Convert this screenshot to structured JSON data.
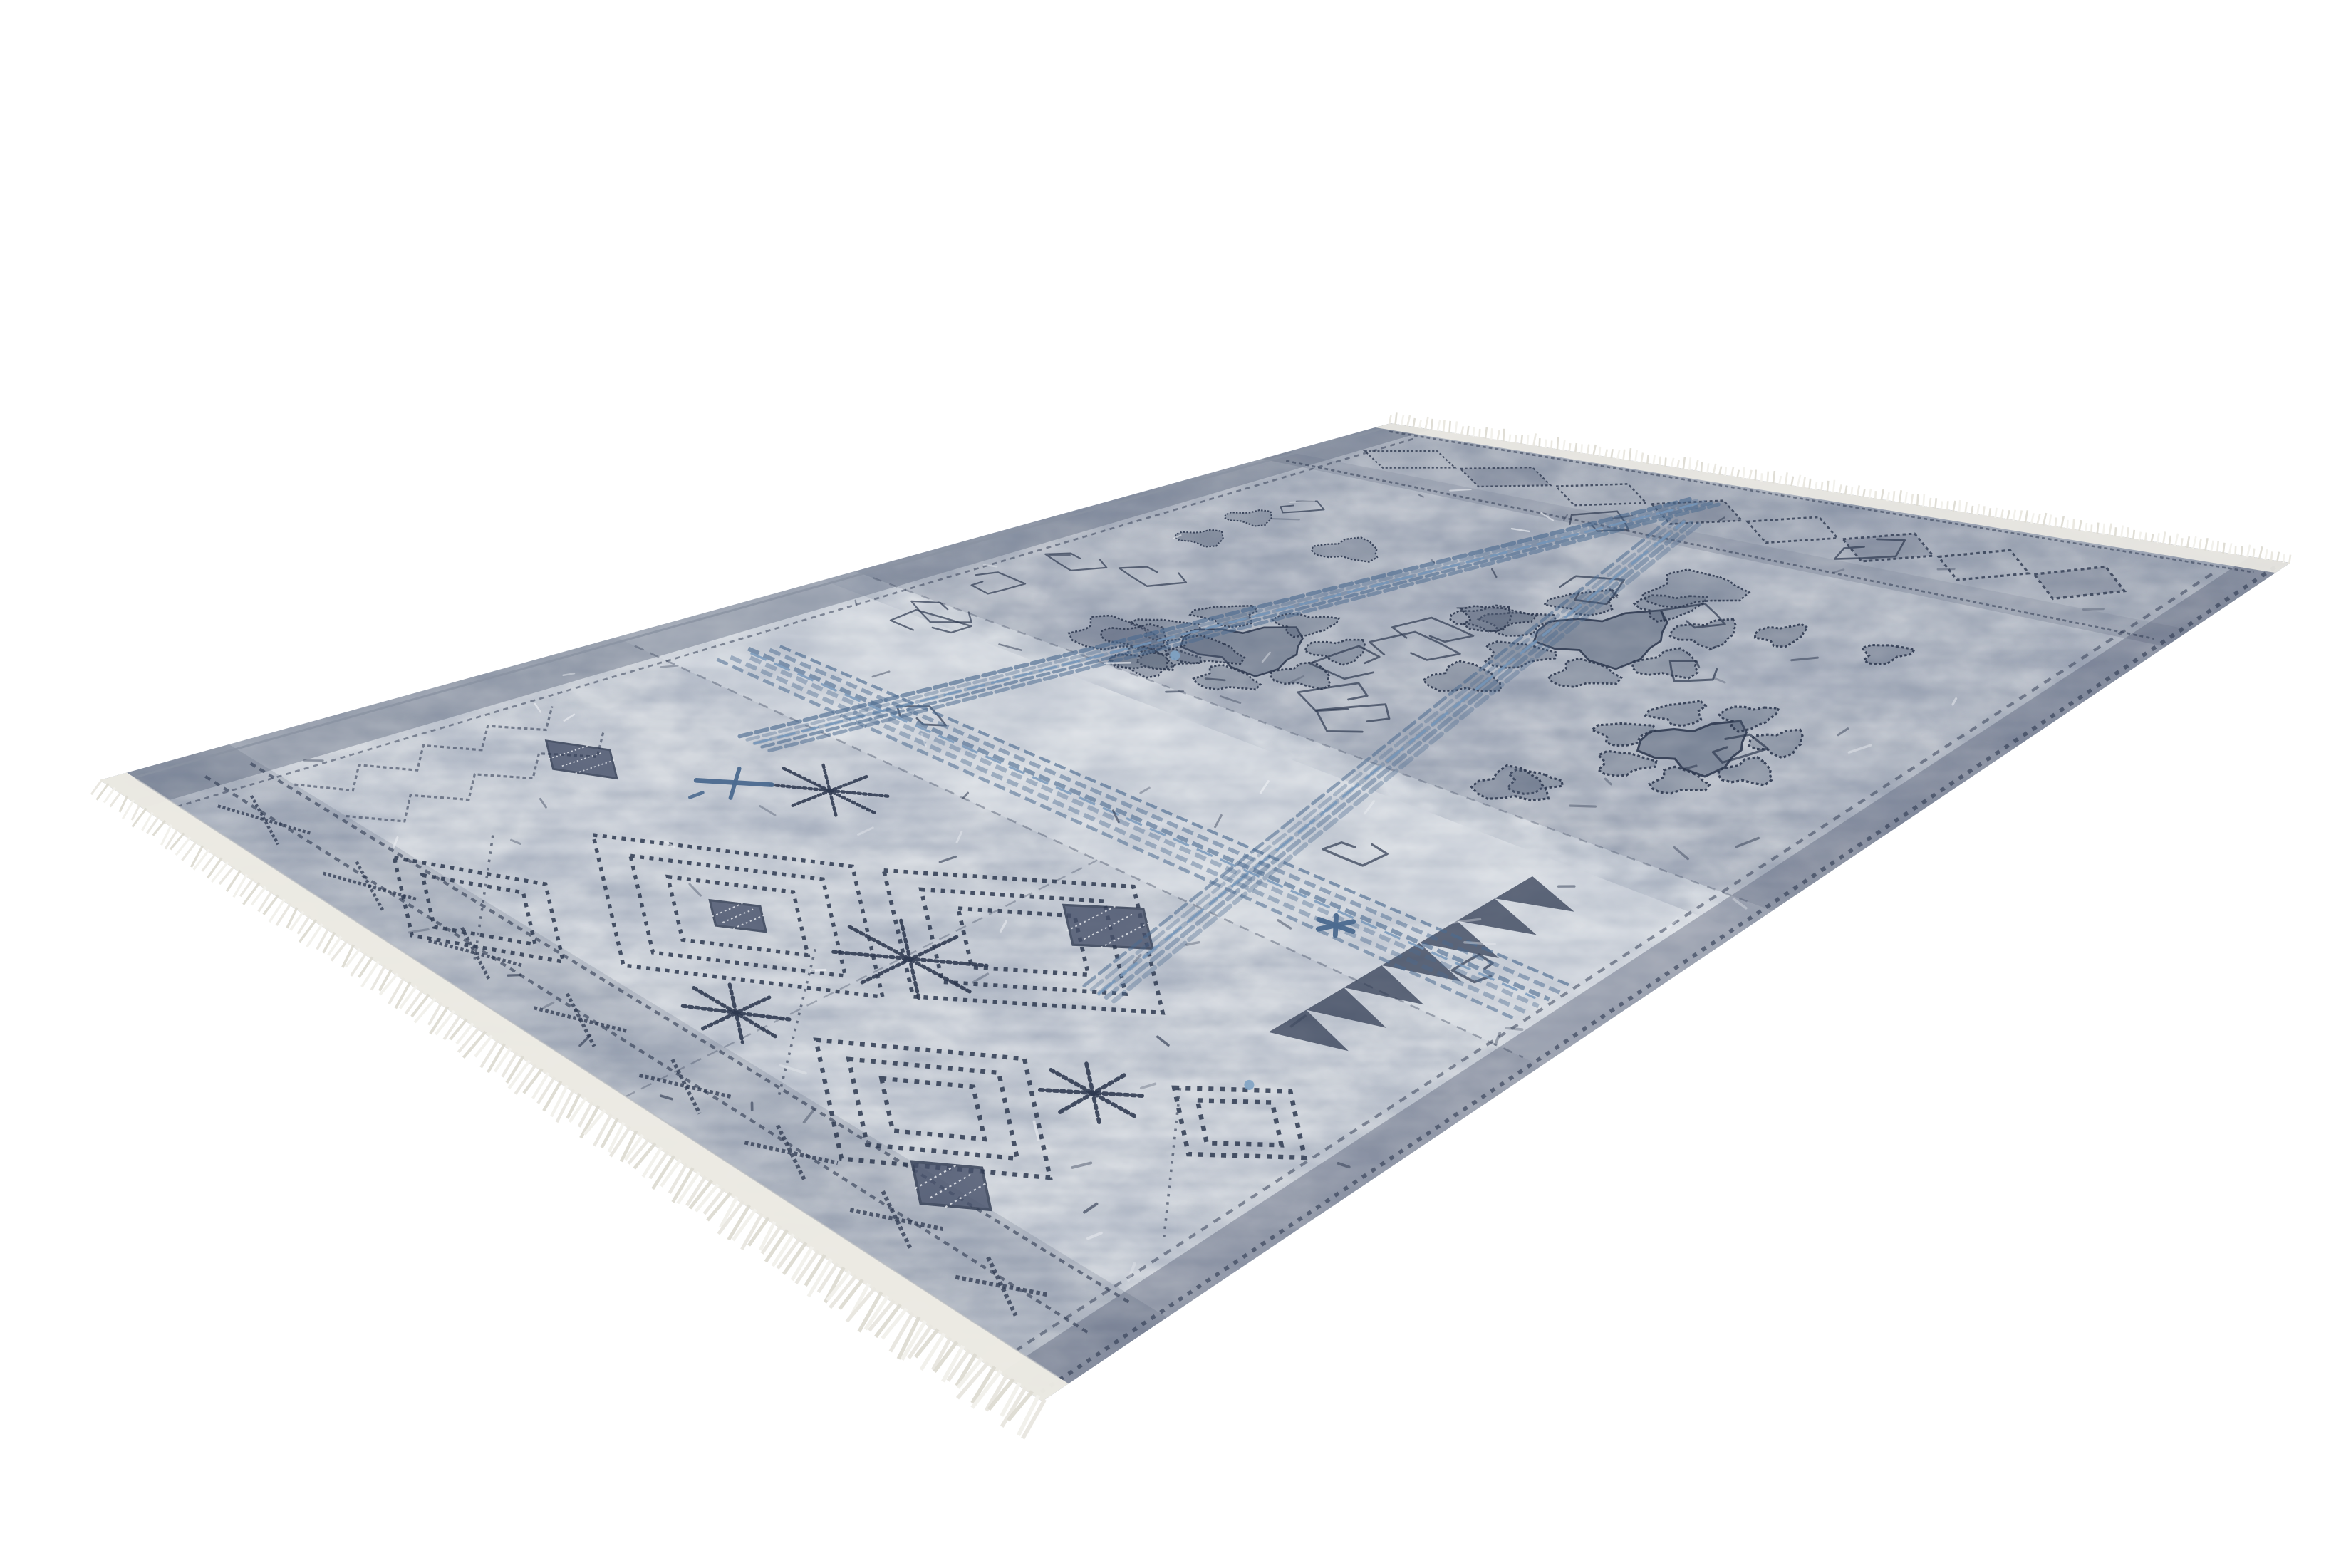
{
  "scene": {
    "description": "Product photo of a rectangular vintage-style area rug shown flat in angled perspective on a plain white background. The rug has a grey-blue patchwork pattern: geometric dotted diamond and snowflake motifs on the left half, dense paisley and floral motifs on the right half, long indigo-blue woven bands crossing near the centre, dark mottled border skirts, and cream fringe tassels along both short ends.",
    "background_color": "#ffffff",
    "rug": {
      "base_color": "#cdd2d9",
      "mottle_dark": "#44506a",
      "mottle_light": "#edeff3",
      "border_color": "#47516a",
      "motif_dark": "#2e3950",
      "motif_slate": "#525e74",
      "accent_blue": "#4c6b90",
      "accent_blue_light": "#7496ba",
      "accent_cyan": "#7fa3c4",
      "fringe_color": "#e9e7e0",
      "fringe_shade": "#dedcd3",
      "fringe_light": "#f2f1ec",
      "selvage_color": "#edebe4",
      "edge_rim": "#8a93a2"
    }
  }
}
